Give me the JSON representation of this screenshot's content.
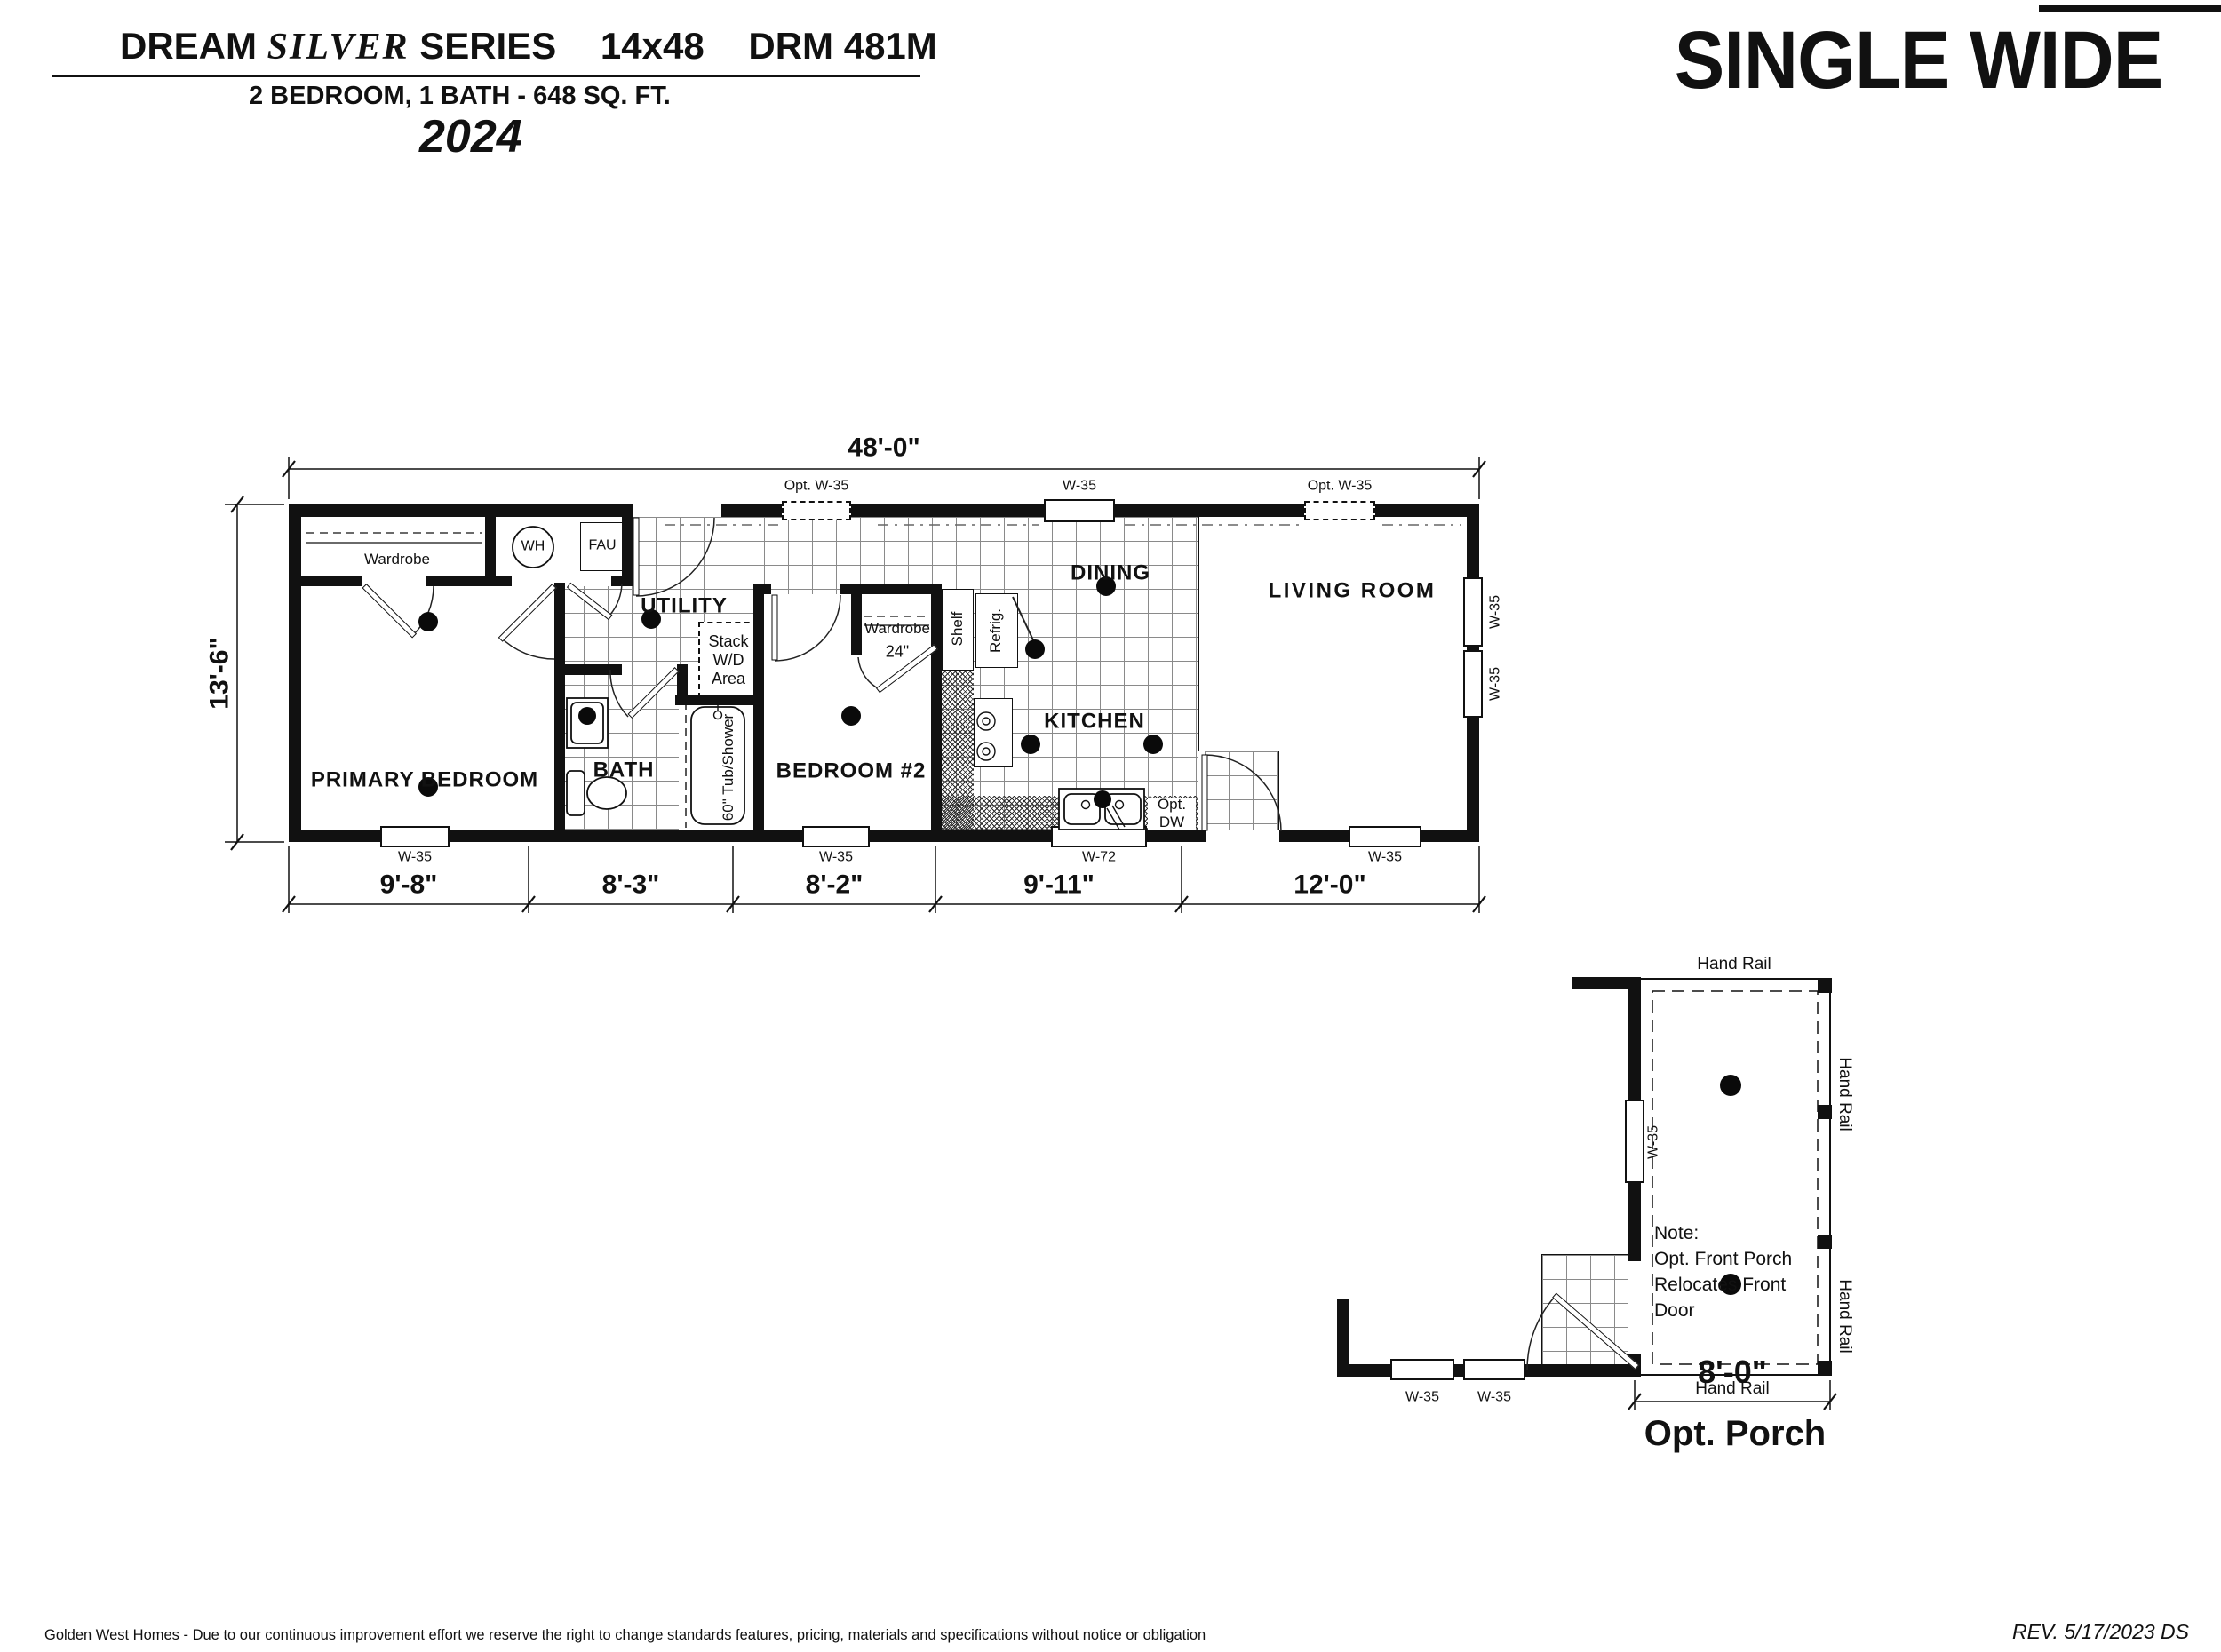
{
  "header": {
    "brand1": "DREAM",
    "brand2": "SILVER",
    "brand3": "SERIES",
    "size": "14x48",
    "model": "DRM 481M",
    "subtitle": "2 BEDROOM, 1 BATH - 648 SQ. FT.",
    "year": "2024",
    "type": "SINGLE WIDE"
  },
  "plan": {
    "width_dim": "48'-0\"",
    "height_dim": "13'-6\"",
    "seg_dims": [
      "9'-8\"",
      "8'-3\"",
      "8'-2\"",
      "9'-11\"",
      "12'-0\""
    ],
    "rooms": {
      "primary": "PRIMARY BEDROOM",
      "bath": "BATH",
      "utility": "UTILITY",
      "bedroom2": "BEDROOM #2",
      "dining": "DINING",
      "kitchen": "KITCHEN",
      "living": "LIVING ROOM"
    },
    "fixtures": {
      "wardrobe": "Wardrobe",
      "wh": "WH",
      "fau": "FAU",
      "stack1": "Stack",
      "stack2": "W/D",
      "stack3": "Area",
      "tub": "60\" Tub/Shower",
      "wardrobe2": "Wardrobe",
      "wardrobe2_size": "24\"",
      "shelf": "Shelf",
      "refrig": "Refrig.",
      "dw1": "Opt.",
      "dw2": "DW"
    },
    "windows": {
      "w35": "W-35",
      "w72": "W-72",
      "optw35": "Opt. W-35"
    }
  },
  "porch": {
    "title": "Opt. Porch",
    "width_dim": "8'-0\"",
    "handrail": "Hand Rail",
    "window": "W-35",
    "note1": "Note:",
    "note2": "Opt. Front Porch",
    "note3": "Relocates Front",
    "note4": "Door"
  },
  "footer": {
    "disclaimer": "Golden West Homes - Due to our continuous improvement effort we reserve the right to change standards features, pricing, materials and specifications without notice or obligation",
    "revision": "REV. 5/17/2023  DS"
  },
  "colors": {
    "ink": "#111111",
    "grid_line": "#8a8a8a"
  }
}
